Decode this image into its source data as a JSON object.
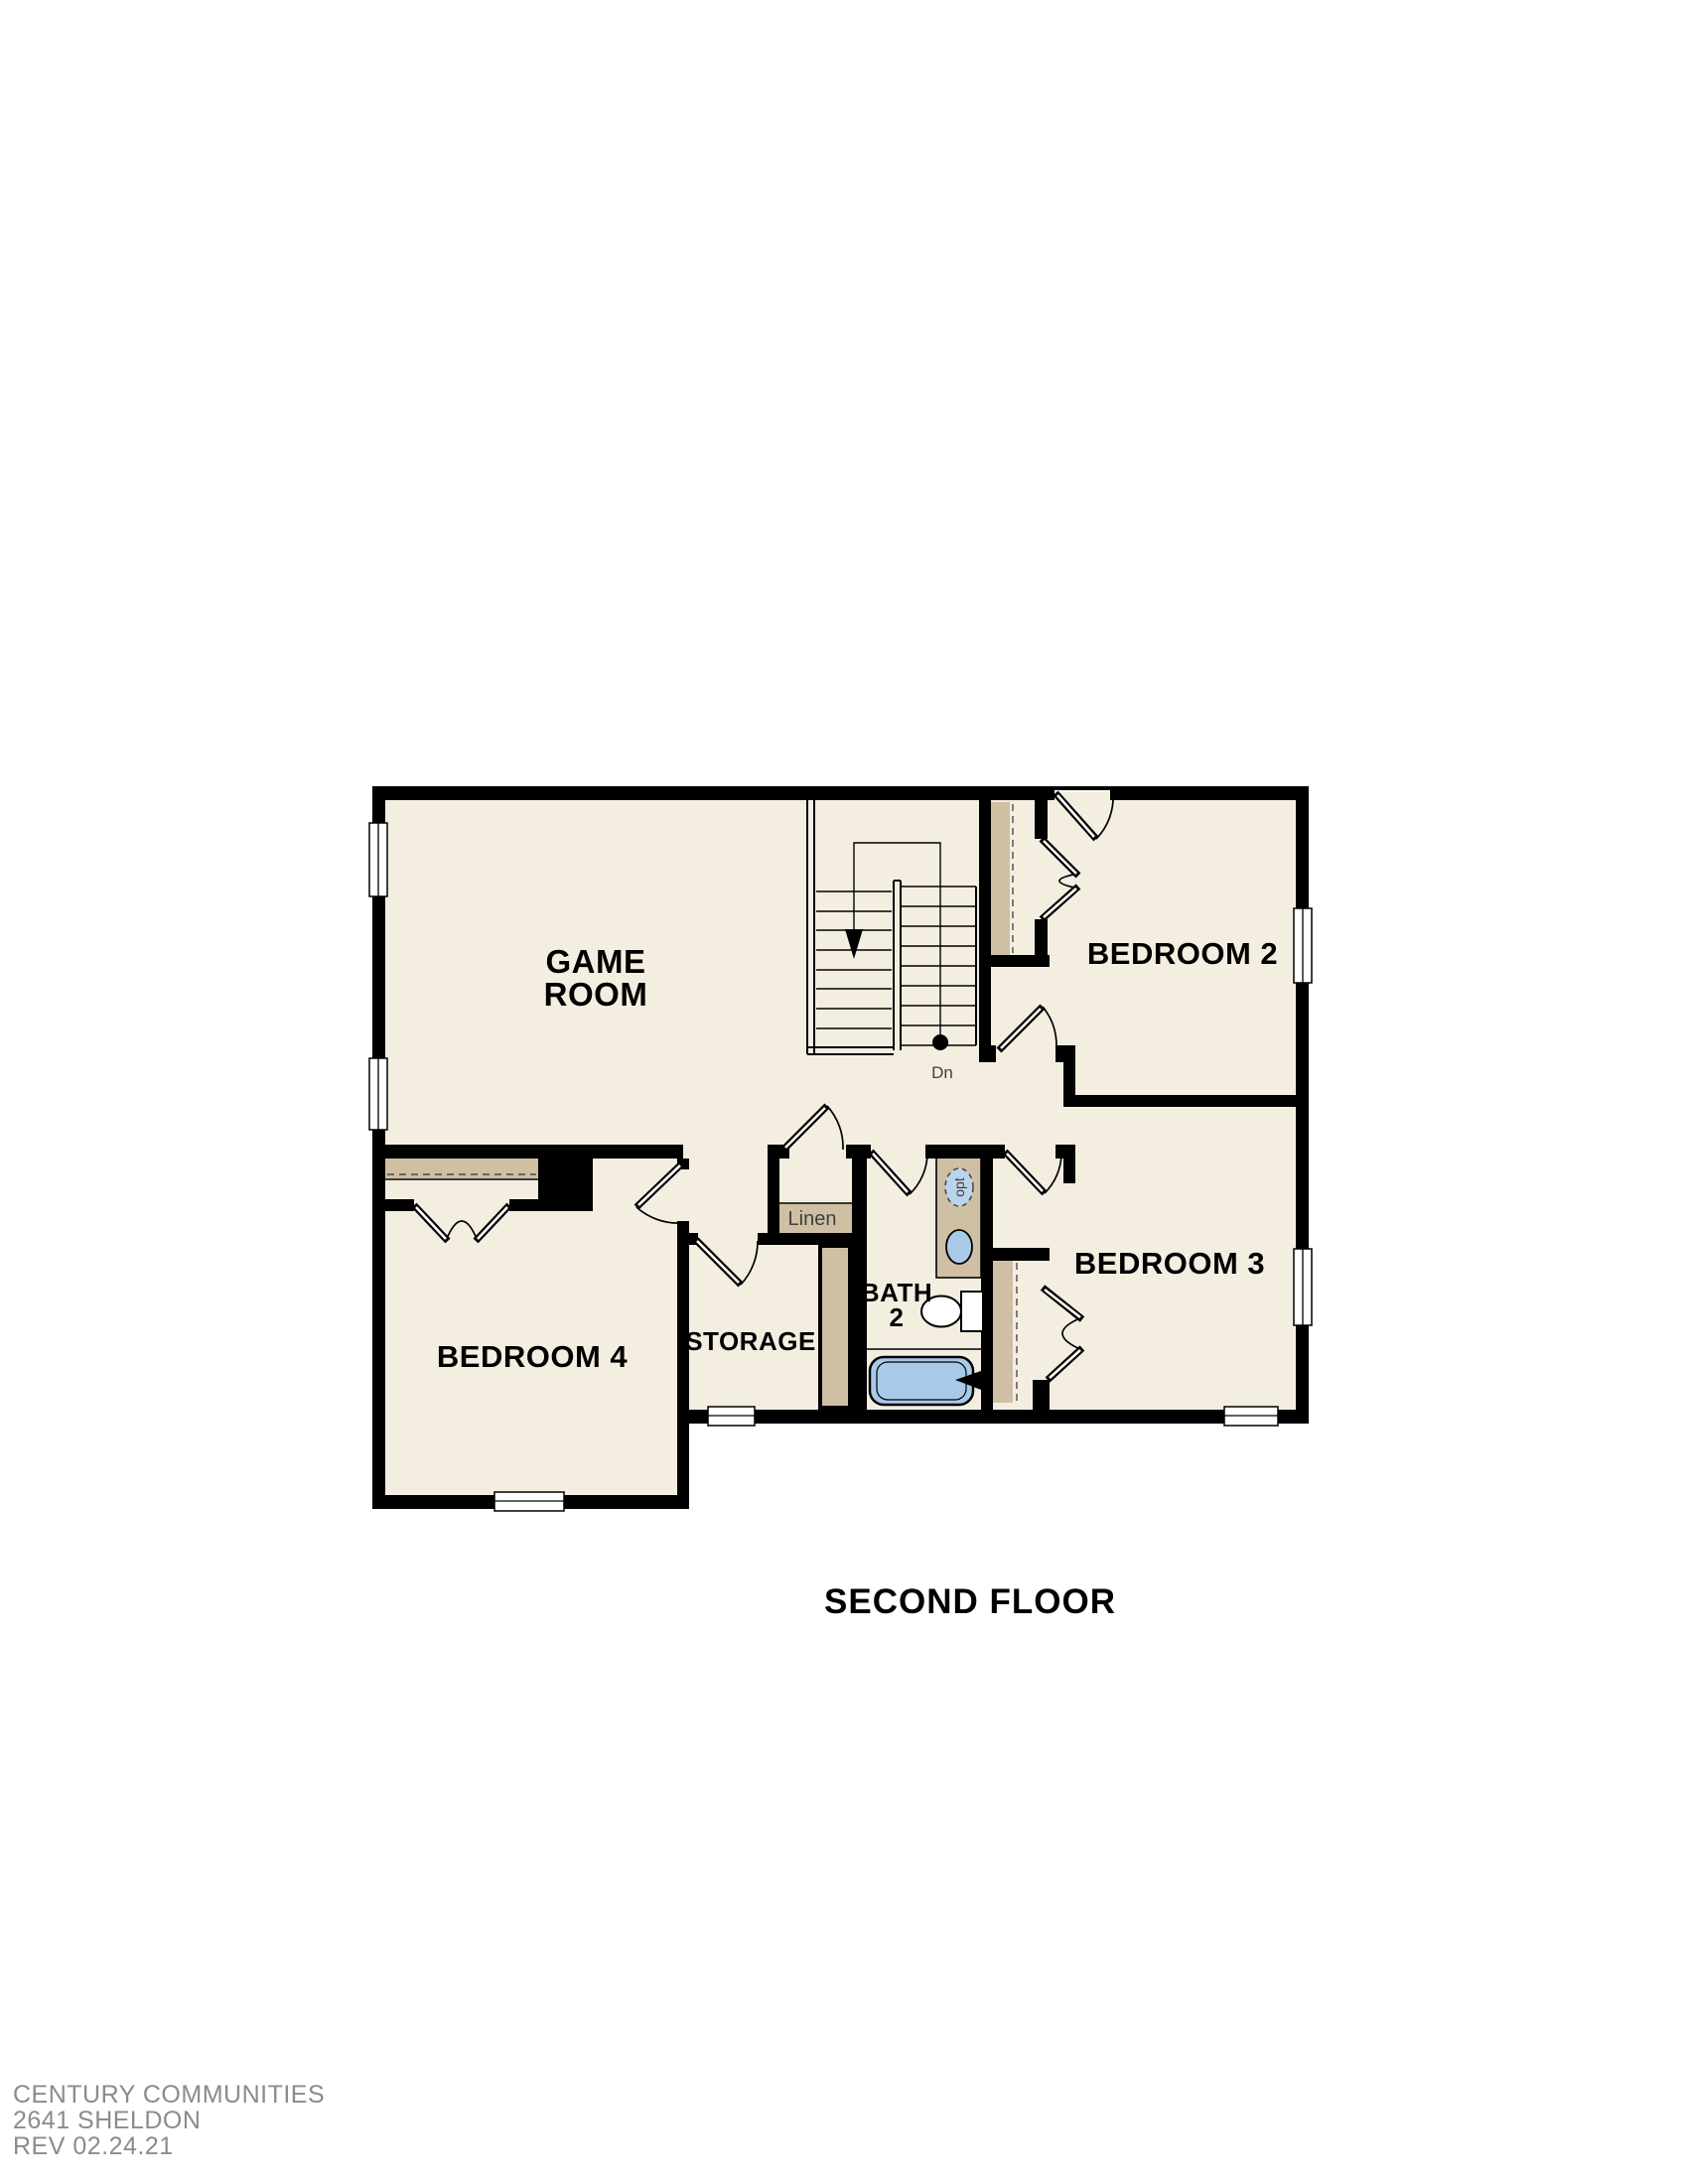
{
  "page": {
    "floor_title": "SECOND FLOOR"
  },
  "rooms": {
    "game_room": {
      "line1": "GAME",
      "line2": "ROOM"
    },
    "bedroom2": {
      "label": "BEDROOM 2"
    },
    "bedroom3": {
      "label": "BEDROOM 3"
    },
    "bedroom4": {
      "label": "BEDROOM 4"
    },
    "storage": {
      "label": "STORAGE"
    },
    "bath2": {
      "line1": "BATH",
      "line2": "2"
    },
    "linen": {
      "label": "Linen"
    }
  },
  "annotations": {
    "stairs_direction": "Dn",
    "optional_fixture": "opt"
  },
  "footer": {
    "company": "CENTURY COMMUNITIES",
    "plan_name": "2641 SHELDON",
    "revision": "REV 02.24.21"
  },
  "colors": {
    "wall": "#000000",
    "floor": "#f4eee1",
    "cabinetry": "#cfbfa3",
    "fixture_blue": "#a9c9e9",
    "fixture_blue_light": "#bad4ec",
    "footer_text": "#8b8b8b",
    "label_text": "#000000",
    "secondary_text": "#3f3f3f"
  }
}
